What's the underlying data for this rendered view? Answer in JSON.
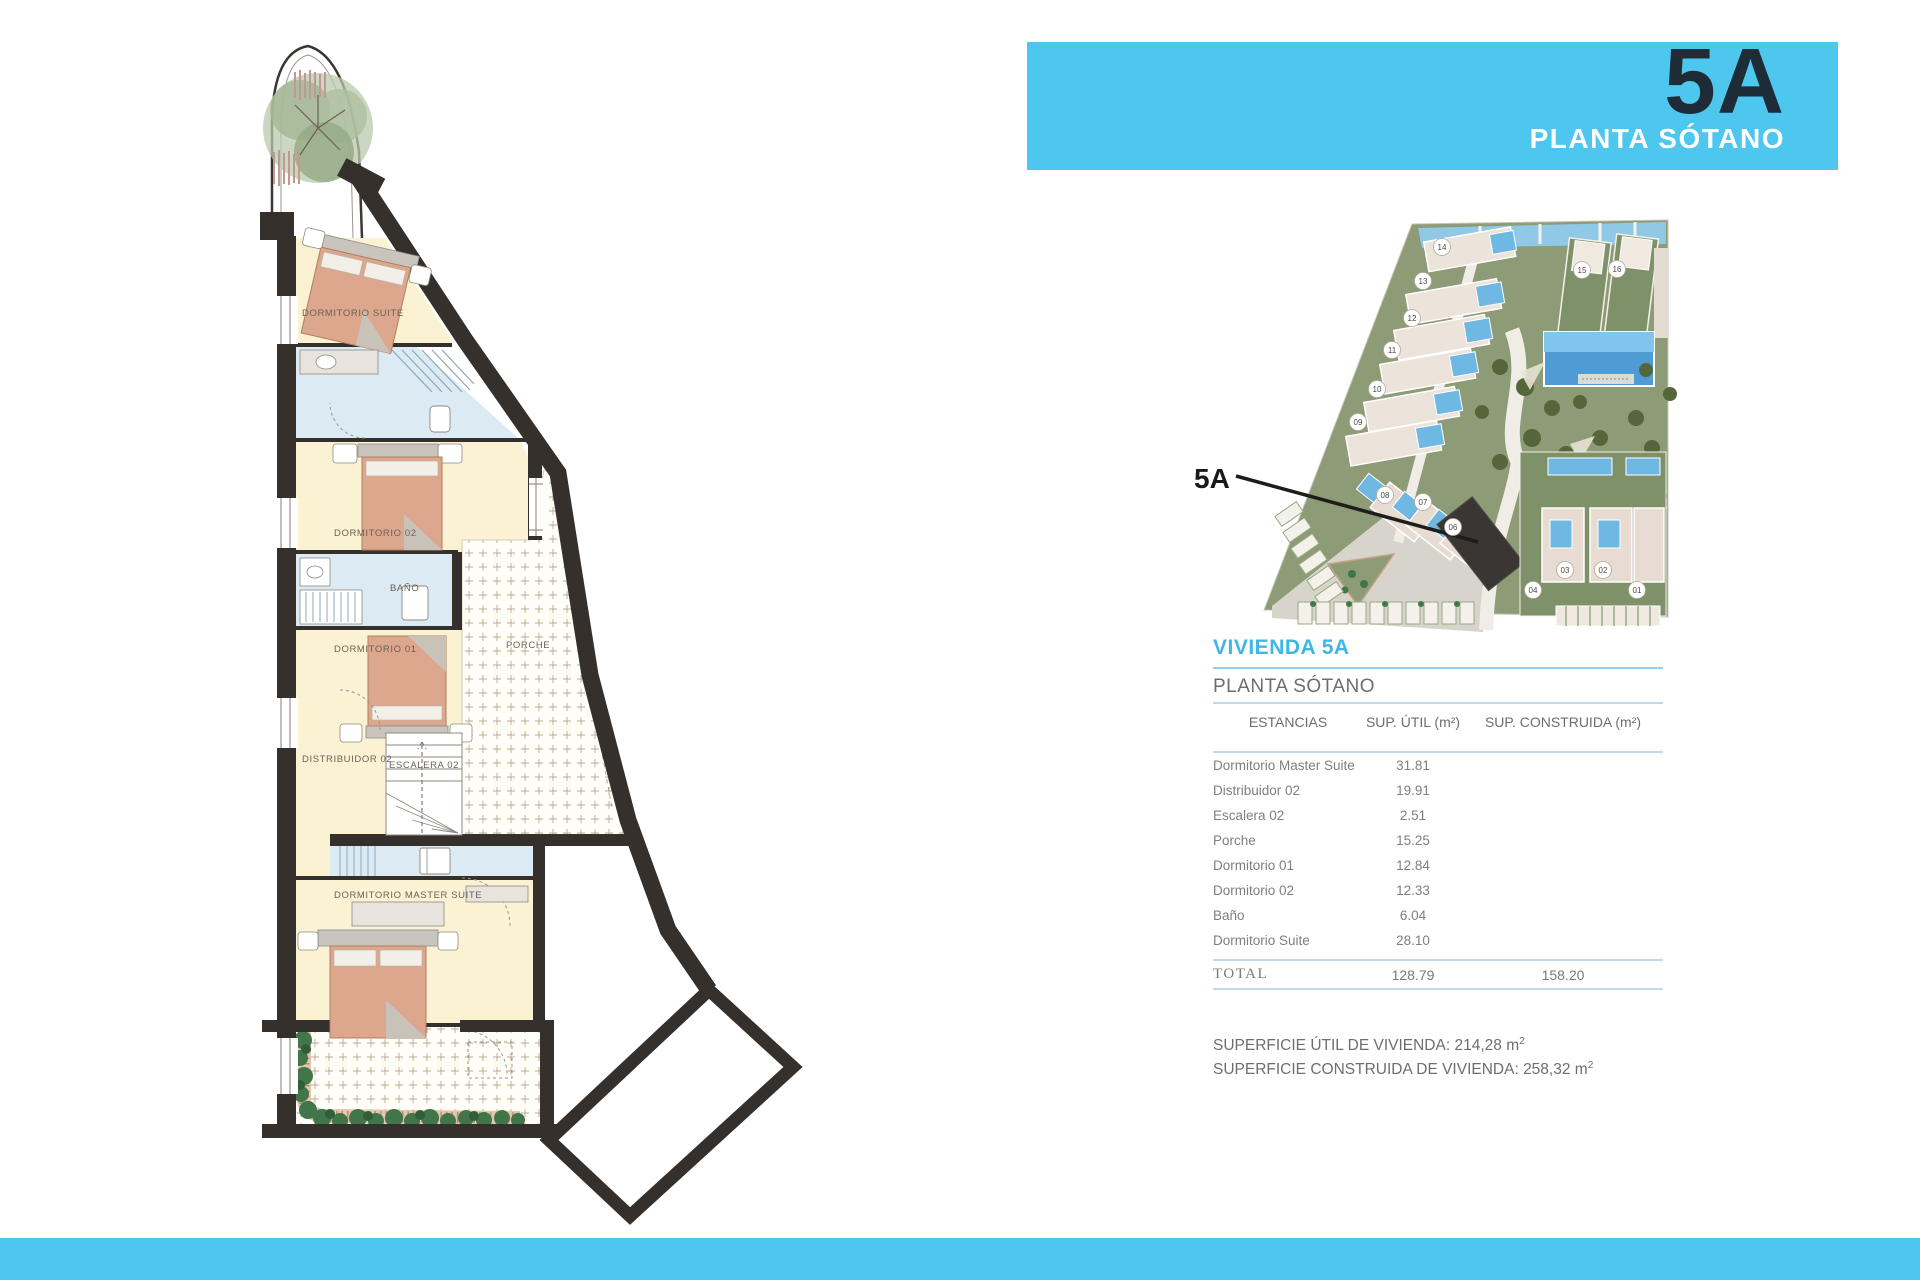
{
  "page": {
    "accent_blue": "#4ec7ef",
    "navy": "#1d2c36",
    "heading_blue": "#3fb6e3",
    "wall_color": "#35302c"
  },
  "header": {
    "unit": "5A",
    "floor": "PLANTA SÓTANO"
  },
  "site_plan": {
    "callout_label": "5A",
    "highlighted_unit": "05",
    "units": [
      "01",
      "02",
      "03",
      "04",
      "06",
      "07",
      "08",
      "09",
      "10",
      "11",
      "12",
      "13",
      "14",
      "15",
      "16"
    ]
  },
  "panel": {
    "title": "VIVIENDA 5A",
    "subtitle": "PLANTA SÓTANO",
    "table": {
      "headers": [
        "ESTANCIAS",
        "SUP. ÚTIL (m²)",
        "SUP. CONSTRUIDA (m²)"
      ],
      "rows": [
        {
          "name": "Dormitorio Master Suite",
          "util": "31.81",
          "constr": ""
        },
        {
          "name": "Distribuidor 02",
          "util": "19.91",
          "constr": ""
        },
        {
          "name": "Escalera 02",
          "util": "2.51",
          "constr": ""
        },
        {
          "name": "Porche",
          "util": "15.25",
          "constr": ""
        },
        {
          "name": "Dormitorio 01",
          "util": "12.84",
          "constr": ""
        },
        {
          "name": "Dormitorio 02",
          "util": "12.33",
          "constr": ""
        },
        {
          "name": "Baño",
          "util": "6.04",
          "constr": ""
        },
        {
          "name": "Dormitorio Suite",
          "util": "28.10",
          "constr": ""
        }
      ],
      "total": {
        "name": "TOTAL",
        "util": "128.79",
        "constr": "158.20"
      }
    },
    "summary": [
      {
        "label": "SUPERFICIE ÚTIL DE VIVIENDA:",
        "value": "214,28",
        "unit": "m",
        "sup": "2"
      },
      {
        "label": "SUPERFICIE CONSTRUIDA DE VIVIENDA:",
        "value": "258,32",
        "unit": "m",
        "sup": "2"
      }
    ]
  },
  "floor_plan": {
    "labels": [
      "DORMITORIO SUITE",
      "DORMITORIO 02",
      "BAÑO",
      "DORMITORIO 01",
      "DISTRIBUIDOR 02",
      "ESCALERA 02",
      "PORCHE",
      "DORMITORIO MASTER SUITE"
    ]
  }
}
